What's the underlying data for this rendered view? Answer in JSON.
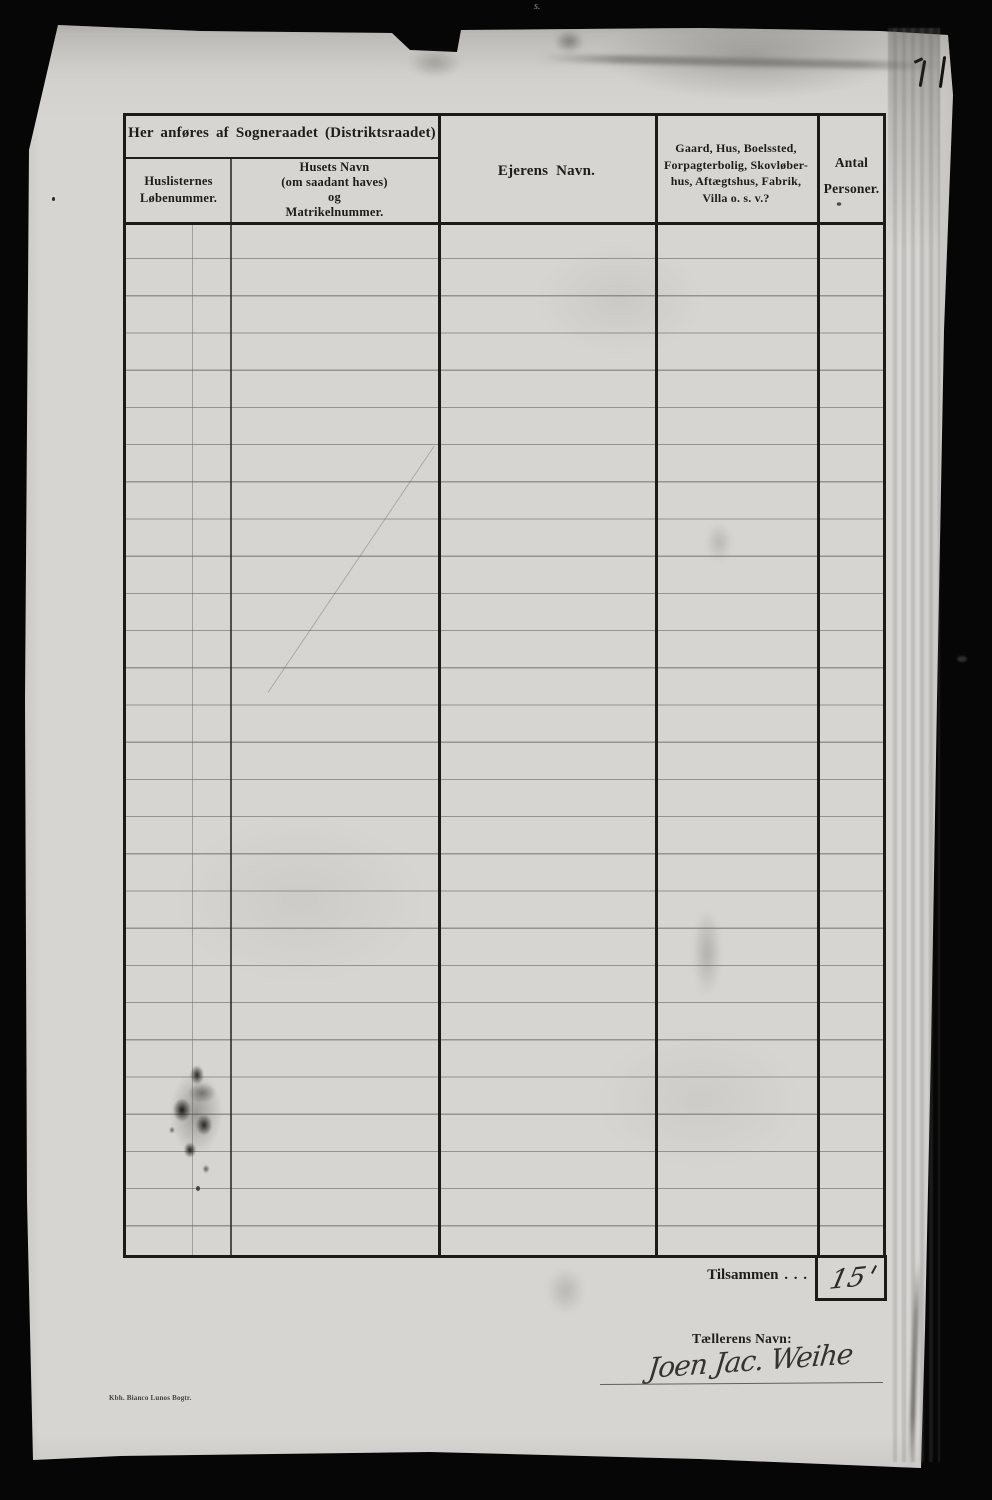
{
  "palette": {
    "scan_background": "#060606",
    "paper": "#d6d5d2",
    "ink": "#1c1b19",
    "ruling_line": "#8f8d88",
    "handwriting": "#2e2c29"
  },
  "table": {
    "group_header": "Her anføres af Sogneraadet (Distriktsraadet)",
    "columns": [
      {
        "lines": [
          "Huslisternes",
          "Løbenummer."
        ]
      },
      {
        "lines": [
          "Husets Navn",
          "(om saadant haves)",
          "og",
          "Matrikelnummer."
        ]
      },
      {
        "lines": [
          "Ejerens Navn."
        ]
      },
      {
        "lines": [
          "Gaard, Hus, Boelssted,",
          "Forpagterbolig, Skovløber-",
          "hus, Aftægtshus, Fabrik,",
          "Villa o. s. v.?"
        ]
      },
      {
        "lines": [
          "Antal",
          "Personer."
        ],
        "footnote_mark": "*"
      }
    ],
    "body_rows_visible": 28,
    "body_rows_empty": true
  },
  "totals": {
    "label": "Tilsammen . . .",
    "value_handwritten": "15"
  },
  "enumerator": {
    "label": "Tællerens Navn:",
    "signature_handwritten": "Joen Jac. Weihe"
  },
  "imprint": "Kbh. Bianco Lunos Bogtr.",
  "stray_marks": {
    "top_edge_squiggle": "s."
  }
}
